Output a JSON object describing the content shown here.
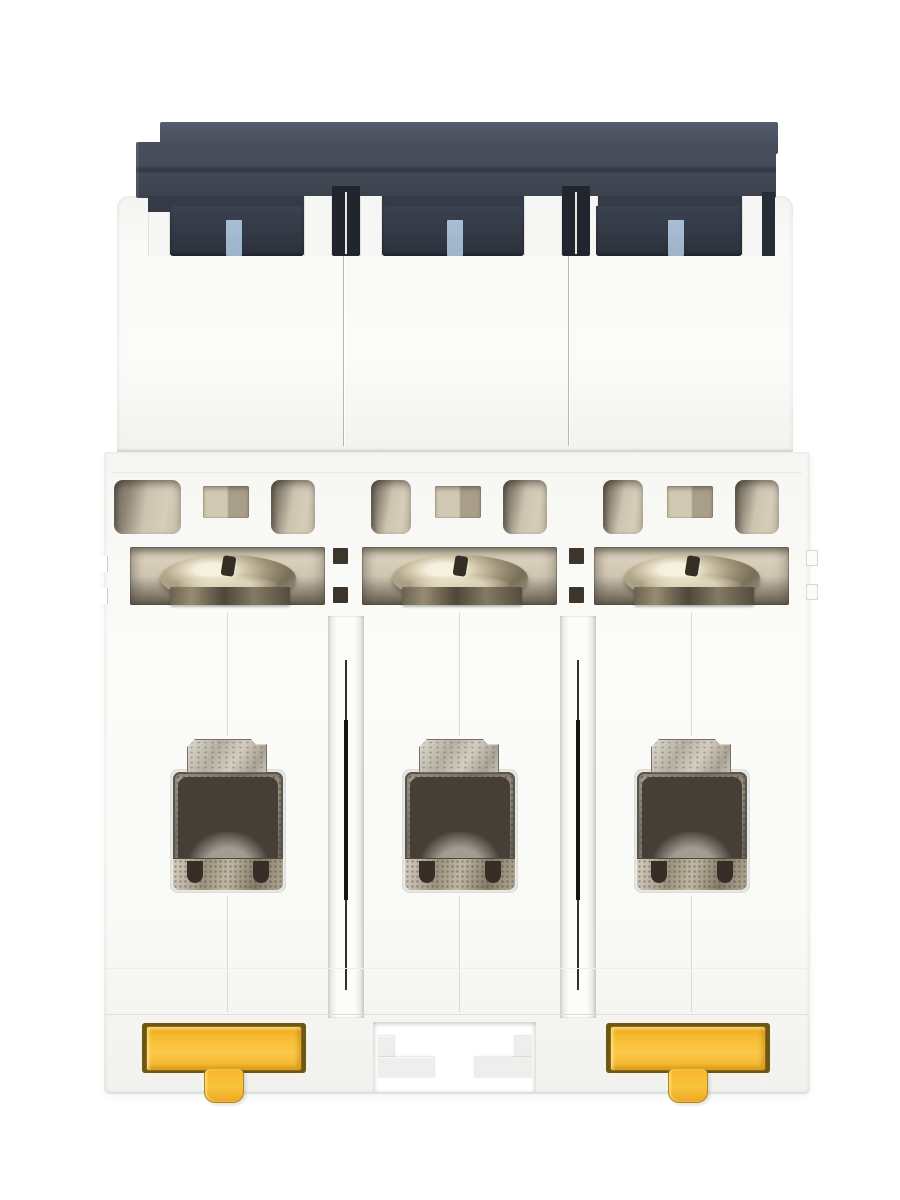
{
  "scene": {
    "type": "product-photograph",
    "subject": "Bottom view of a white 3-pole DIN-rail miniature circuit breaker",
    "pole_count": 3,
    "background_color": "#ffffff",
    "visible_text": ""
  },
  "components": {
    "top_cap": "dark slate stacked housing cap",
    "pole_markers": "light blue indicator tabs, one per pole",
    "vents": "beige ventilation slots, two plus a center port per pole",
    "terminal_screws": "three slotted metallic terminal screws",
    "terminal_cages": "three wire clamp cages with metal tabs",
    "din_clips": "two yellow DIN-rail latch clips on outer poles",
    "middle_cutout": "T-shaped rail cutout on middle pole"
  },
  "colors": {
    "cap_dark": "#3f4551",
    "cap_band": "#343a46",
    "body_white": "#f7f7f5",
    "vent_beige": "#cdc4b0",
    "screw_metal": "#a3977c",
    "terminal_taupe": "#8f8579",
    "clip_yellow": "#f7ba31",
    "clip_outline": "#6e5710",
    "marker_blue": "#a8bed4",
    "groove_line": "#2a2520"
  }
}
